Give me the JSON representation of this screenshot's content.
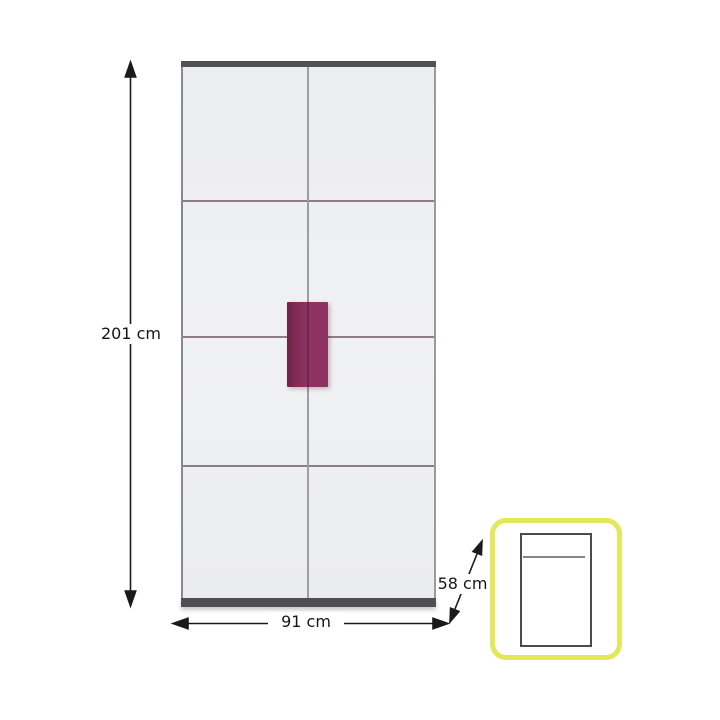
{
  "diagram": {
    "title": "wardrobe-dimension-diagram",
    "front_view": {
      "description": "two-door wardrobe front elevation with centre handle",
      "height_label": "201 cm",
      "width_label": "91 cm"
    },
    "side_inset": {
      "description": "top view inset showing depth",
      "depth_label": "58 cm"
    },
    "icons": {
      "height_arrow": "double-headed-vertical-arrow",
      "width_arrow": "double-headed-horizontal-arrow",
      "depth_arrow": "double-headed-diagonal-arrow"
    },
    "colors": {
      "background": "#ffffff",
      "door_face": "#eef0f1",
      "frame_dark": "#515156",
      "panel_seam_line": "#8f7c88",
      "door_gap_line": "#9d9da2",
      "handle": "#8b3160",
      "handle_edge": "#6e2348",
      "inset_border": "#e3e75a",
      "top_view_outline": "#4b4b4f",
      "dimension_line": "#1a1a1a"
    }
  }
}
